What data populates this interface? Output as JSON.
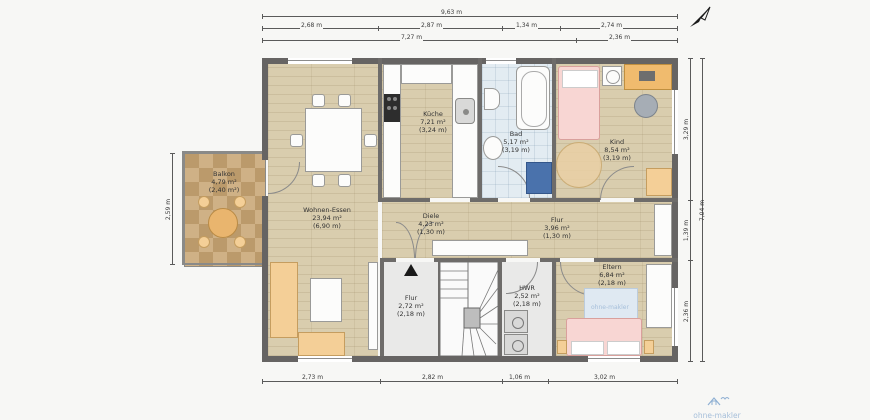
{
  "meta": {
    "brand": "ohne-makler"
  },
  "rooms": {
    "balkon": {
      "name": "Balkon",
      "area": "4,79 m²",
      "note": "(2,40 m²)"
    },
    "wohnen": {
      "name": "Wohnen-Essen",
      "area": "23,94 m²",
      "note": "(6,90 m)"
    },
    "kueche": {
      "name": "Küche",
      "area": "7,21 m²",
      "note": "(3,24 m)"
    },
    "bad": {
      "name": "Bad",
      "area": "5,17 m²",
      "note": "(3,19 m)"
    },
    "kind": {
      "name": "Kind",
      "area": "8,54 m²",
      "note": "(3,19 m)"
    },
    "diele": {
      "name": "Diele",
      "area": "4,23 m²",
      "note": "(1,30 m)"
    },
    "flur": {
      "name": "Flur",
      "area": "3,96 m²",
      "note": "(1,30 m)"
    },
    "treppe": {
      "name": "Flur",
      "area": "2,72 m²",
      "note": "(2,18 m)"
    },
    "hwr": {
      "name": "HWR",
      "area": "2,52 m²",
      "note": "(2,18 m)"
    },
    "eltern": {
      "name": "Eltern",
      "area": "6,84 m²",
      "note": "(2,18 m)"
    }
  },
  "dimensions": {
    "top_total": "9,63 m",
    "top_row2": [
      "2,68 m",
      "2,87 m",
      "1,34 m",
      "2,74 m"
    ],
    "top_row3": [
      "7,27 m",
      "2,36 m"
    ],
    "bottom": [
      "2,73 m",
      "2,82 m",
      "1,06 m",
      "3,02 m"
    ],
    "right_total": "7,04 m",
    "right_segments": [
      "3,29 m",
      "1,39 m",
      "2,36 m"
    ],
    "left": "2,59 m"
  }
}
